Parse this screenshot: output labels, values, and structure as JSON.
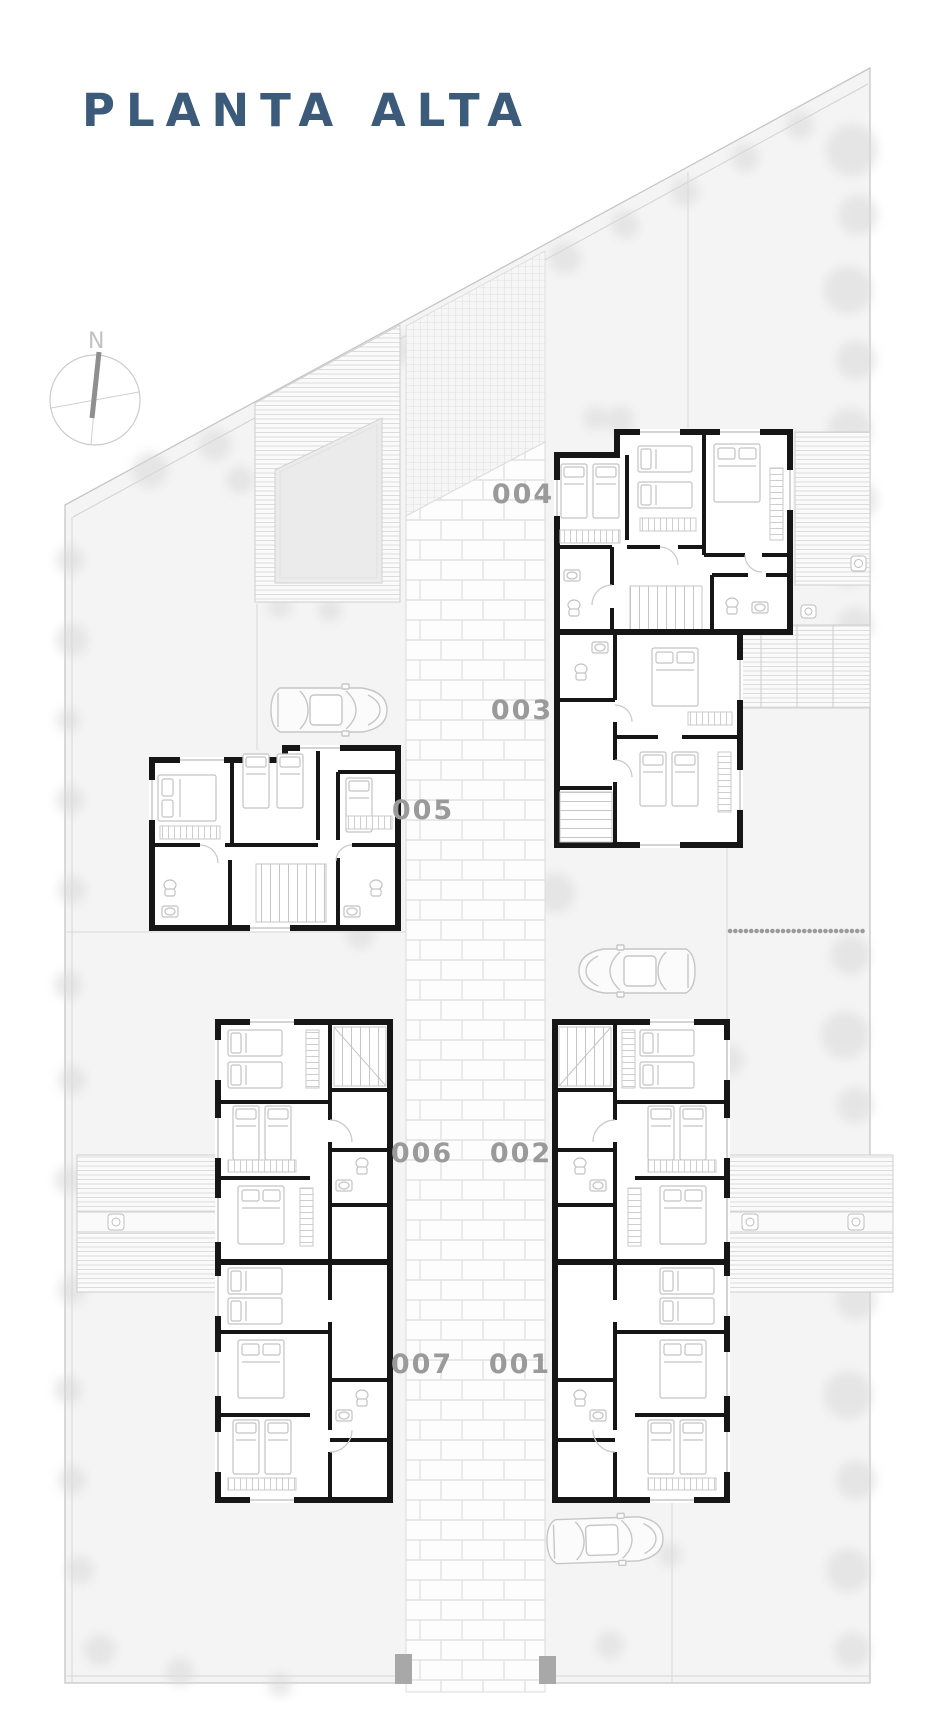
{
  "title": "PLANTA ALTA",
  "compass": {
    "label": "N"
  },
  "units": [
    {
      "label": "004"
    },
    {
      "label": "003"
    },
    {
      "label": "005"
    },
    {
      "label": "006"
    },
    {
      "label": "002"
    },
    {
      "label": "007"
    },
    {
      "label": "001"
    }
  ],
  "colors": {
    "title_blue": "#3c5a7a",
    "wall_black": "#161616",
    "site_gray": "#f4f4f4",
    "label_gray": "#9a9a9a",
    "furniture_gray": "#c3c3c3",
    "post_gray": "#a8a8a8"
  }
}
